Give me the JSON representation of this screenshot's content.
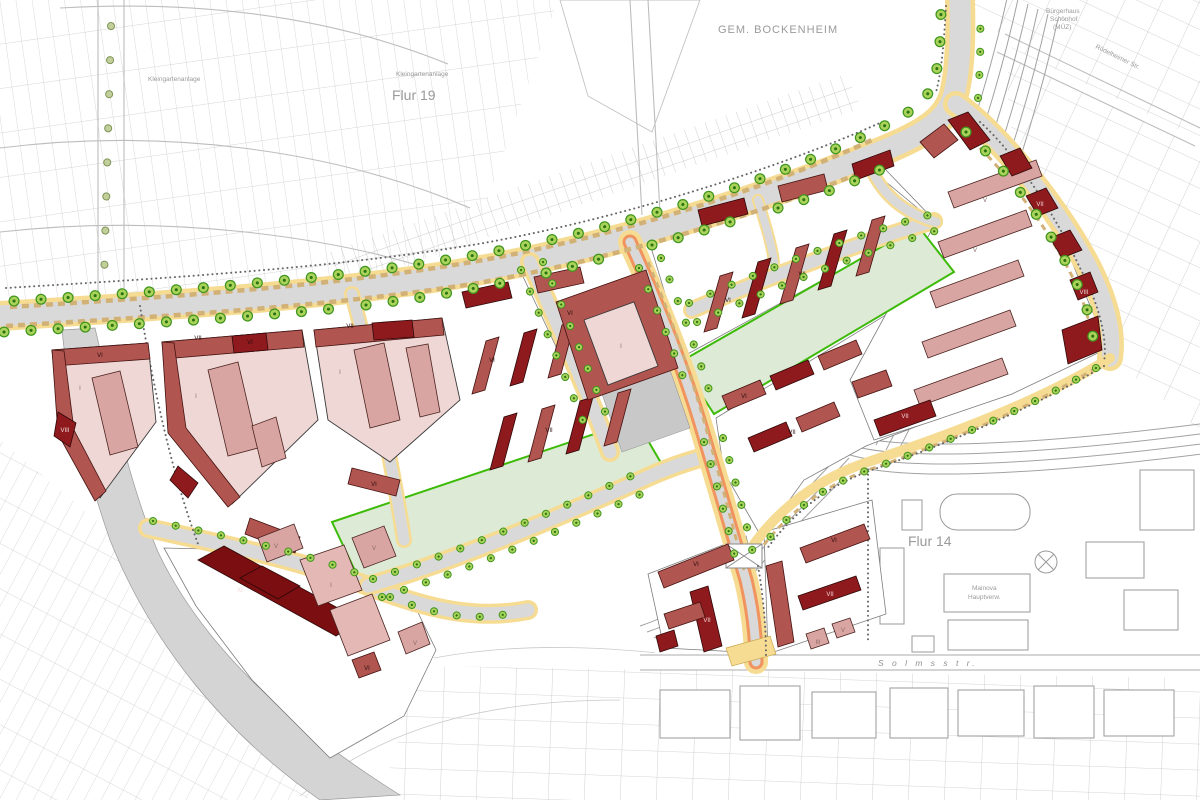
{
  "map": {
    "type": "urban development site plan",
    "district_labels": {
      "gemeinde": "GEM. BOCKENHEIM",
      "flur19": "Flur 19",
      "flur14": "Flur 14",
      "kleingarten_west": "Kleingartenanlage",
      "kleingarten_east": "Kleingartenanlage",
      "solmsstr": "S o l m s s t r.",
      "roedelheimer": "Rödelheimer Str.",
      "buergerhaus_line1": "Bürgerhaus",
      "buergerhaus_line2": "Schönhof",
      "buergerhaus_line3": "(MÜZ)",
      "mainova_line1": "Mainova",
      "mainova_line2": "Hauptverw."
    },
    "storeys": {
      "i": "I",
      "iii": "III",
      "iv": "IV",
      "v": "V",
      "vi": "VI",
      "vii": "VII",
      "viii": "VIII",
      "xi": "XI"
    },
    "palette": {
      "building_dark_red": "#8e1a1e",
      "building_medium_red": "#b05550",
      "building_pink": "#d9a5a2",
      "building_light_pink": "#eed7d4",
      "building_deep_red": "#7a0e10",
      "park_green": "#ddead5",
      "tree_green": "#a9d35b",
      "street_gray": "#d9d9d9",
      "sidewalk_yellow": "#f6dc92",
      "tram_orange": "#f0935f",
      "cadastral_gray": "#c9c9c9"
    }
  }
}
